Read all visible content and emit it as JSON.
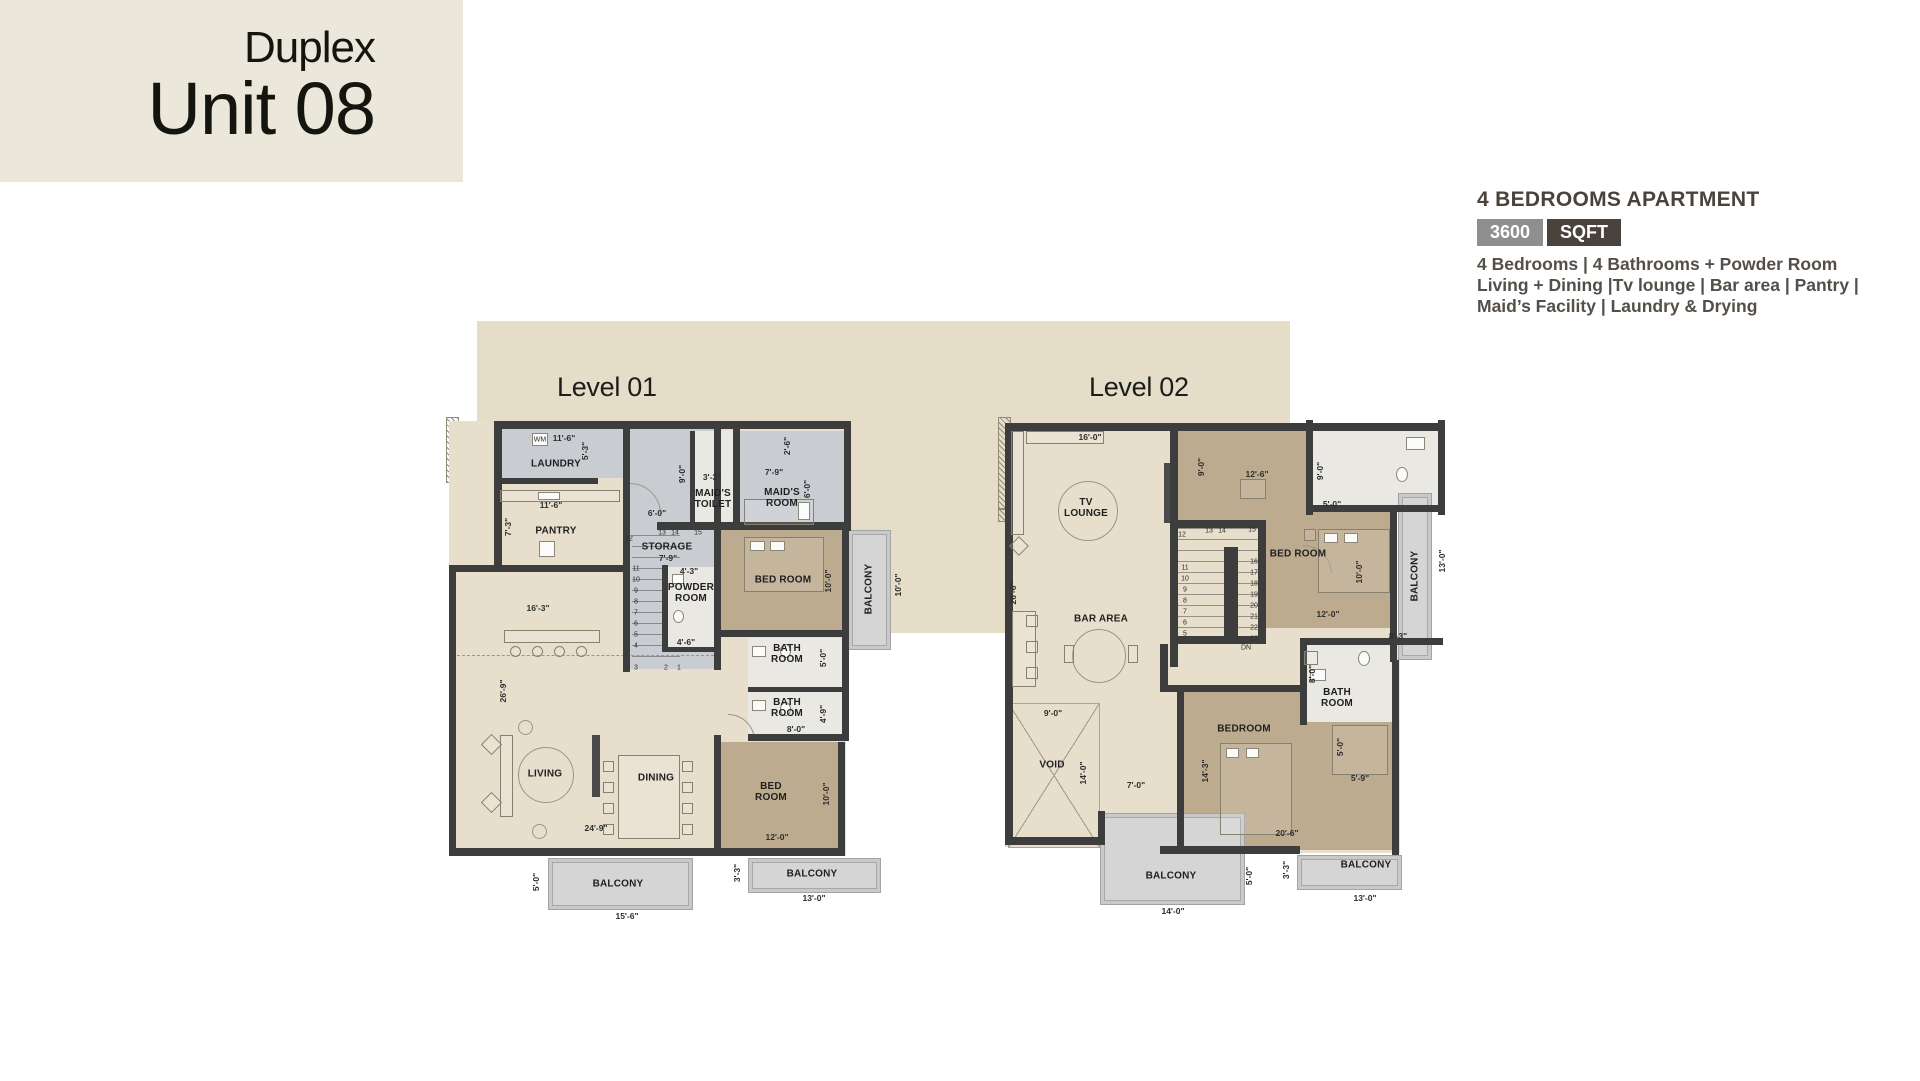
{
  "unit_card": {
    "subtitle": "Duplex",
    "title": "Unit 08"
  },
  "info": {
    "title": "4 BEDROOMS APARTMENT",
    "area_value": "3600",
    "area_unit": "SQFT",
    "features": [
      "4 Bedrooms  |  4 Bathrooms + Powder Room",
      "Living + Dining |Tv lounge  |  Bar area  |  Pantry  |",
      "Maid’s Facility  |  Laundry & Drying"
    ]
  },
  "colors": {
    "card_bg": "#ebe7da",
    "backdrop": "#e5ddc8",
    "wall": "#3d3d3d",
    "floor_cream": "#e7dfcc",
    "floor_grey": "#c9ccd1",
    "floor_bath": "#eae8e3",
    "floor_bedroom": "#bcab8f",
    "balcony": "#d5d5d6",
    "badge_grey": "#8f8f8f",
    "badge_dark": "#4a433b"
  },
  "levels": [
    {
      "label": "Level 01",
      "rooms": {
        "laundry": "LAUNDRY",
        "pantry": "PANTRY",
        "maids_toilet": "MAID'S\nTOILET",
        "maids_room": "MAID'S\nROOM",
        "storage": "STORAGE",
        "powder": "POWDER\nROOM",
        "bedroom1": "BED ROOM",
        "bath1": "BATH\nROOM",
        "bath2": "BATH\nROOM",
        "bedroom2": "BED\nROOM",
        "living": "LIVING",
        "dining": "DINING",
        "balcony_r": "BALCONY",
        "balcony_b": "BALCONY",
        "balcony_br": "BALCONY"
      },
      "dims": [
        {
          "t": "11'-6\"",
          "x": 118,
          "y": 21
        },
        {
          "t": "WM",
          "x": 94,
          "y": 23,
          "s": 1
        },
        {
          "t": "5'-3\"",
          "x": 139,
          "y": 34,
          "v": 1
        },
        {
          "t": "11'-6\"",
          "x": 105,
          "y": 88
        },
        {
          "t": "7'-3\"",
          "x": 62,
          "y": 110,
          "v": 1
        },
        {
          "t": "9'-0\"",
          "x": 236,
          "y": 57,
          "v": 1
        },
        {
          "t": "6'-0\"",
          "x": 211,
          "y": 96
        },
        {
          "t": "3'-3\"",
          "x": 266,
          "y": 60
        },
        {
          "t": "7'-9\"",
          "x": 328,
          "y": 55
        },
        {
          "t": "2'-6\"",
          "x": 341,
          "y": 29,
          "v": 1
        },
        {
          "t": "6'-0\"",
          "x": 361,
          "y": 72,
          "v": 1
        },
        {
          "t": "16'-3\"",
          "x": 92,
          "y": 191
        },
        {
          "t": "26'-9\"",
          "x": 57,
          "y": 274,
          "v": 1
        },
        {
          "t": "24'-9\"",
          "x": 150,
          "y": 411
        },
        {
          "t": "7'-9\"",
          "x": 222,
          "y": 141
        },
        {
          "t": "4'-3\"",
          "x": 243,
          "y": 154
        },
        {
          "t": "4'-6\"",
          "x": 240,
          "y": 225
        },
        {
          "t": "10'-0\"",
          "x": 382,
          "y": 164,
          "v": 1
        },
        {
          "t": "10'-0\"",
          "x": 452,
          "y": 168,
          "v": 1
        },
        {
          "t": "5'-0\"",
          "x": 377,
          "y": 241,
          "v": 1
        },
        {
          "t": "4'-9\"",
          "x": 377,
          "y": 297,
          "v": 1
        },
        {
          "t": "8'-0\"",
          "x": 350,
          "y": 312
        },
        {
          "t": "12'-0\"",
          "x": 331,
          "y": 420
        },
        {
          "t": "10'-0\"",
          "x": 380,
          "y": 377,
          "v": 1
        },
        {
          "t": "5'-0\"",
          "x": 90,
          "y": 465,
          "v": 1
        },
        {
          "t": "15'-6\"",
          "x": 181,
          "y": 499
        },
        {
          "t": "3'-3\"",
          "x": 291,
          "y": 456,
          "v": 1
        },
        {
          "t": "13'-0\"",
          "x": 368,
          "y": 481
        },
        {
          "t": "13",
          "x": 216,
          "y": 116,
          "s": 1
        },
        {
          "t": "14",
          "x": 229,
          "y": 116,
          "s": 1
        },
        {
          "t": "15",
          "x": 252,
          "y": 116,
          "s": 1
        },
        {
          "t": "12",
          "x": 183,
          "y": 122,
          "s": 1
        },
        {
          "t": "11",
          "x": 190,
          "y": 152,
          "s": 1
        },
        {
          "t": "10",
          "x": 190,
          "y": 163,
          "s": 1
        },
        {
          "t": "9",
          "x": 190,
          "y": 174,
          "s": 1
        },
        {
          "t": "8",
          "x": 190,
          "y": 185,
          "s": 1
        },
        {
          "t": "7",
          "x": 190,
          "y": 196,
          "s": 1
        },
        {
          "t": "6",
          "x": 190,
          "y": 207,
          "s": 1
        },
        {
          "t": "5",
          "x": 190,
          "y": 218,
          "s": 1
        },
        {
          "t": "4",
          "x": 190,
          "y": 229,
          "s": 1
        },
        {
          "t": "3",
          "x": 190,
          "y": 251,
          "s": 1
        },
        {
          "t": "2",
          "x": 220,
          "y": 251,
          "s": 1
        },
        {
          "t": "1",
          "x": 233,
          "y": 251,
          "s": 1
        }
      ]
    },
    {
      "label": "Level 02",
      "rooms": {
        "tv_lounge": "TV\nLOUNGE",
        "bar": "BAR AREA",
        "void": "VOID",
        "bedroom_t": "BED ROOM",
        "bedroom_b": "BEDROOM",
        "bath_b": "BATH\nROOM",
        "balcony_r": "BALCONY",
        "balcony_bl": "BALCONY",
        "balcony_br": "BALCONY"
      },
      "dims": [
        {
          "t": "16'-0\"",
          "x": 92,
          "y": 20
        },
        {
          "t": "26'-6\"",
          "x": 15,
          "y": 176,
          "v": 1
        },
        {
          "t": "9'-0\"",
          "x": 203,
          "y": 50,
          "v": 1
        },
        {
          "t": "12'-6\"",
          "x": 259,
          "y": 57
        },
        {
          "t": "9'-0\"",
          "x": 322,
          "y": 54,
          "v": 1
        },
        {
          "t": "5'-0\"",
          "x": 334,
          "y": 87
        },
        {
          "t": "10'-0\"",
          "x": 361,
          "y": 155,
          "v": 1
        },
        {
          "t": "12'-0\"",
          "x": 330,
          "y": 197
        },
        {
          "t": "13'-0\"",
          "x": 444,
          "y": 144,
          "v": 1
        },
        {
          "t": "8'-3\"",
          "x": 400,
          "y": 219
        },
        {
          "t": "8'-0\"",
          "x": 314,
          "y": 257,
          "v": 1
        },
        {
          "t": "5'-0\"",
          "x": 342,
          "y": 330,
          "v": 1
        },
        {
          "t": "5'-9\"",
          "x": 362,
          "y": 361
        },
        {
          "t": "14'-3\"",
          "x": 207,
          "y": 354,
          "v": 1
        },
        {
          "t": "20'-6\"",
          "x": 289,
          "y": 416
        },
        {
          "t": "9'-0\"",
          "x": 55,
          "y": 296
        },
        {
          "t": "14'-0\"",
          "x": 85,
          "y": 356,
          "v": 1
        },
        {
          "t": "7'-0\"",
          "x": 138,
          "y": 368
        },
        {
          "t": "14'-0\"",
          "x": 175,
          "y": 494
        },
        {
          "t": "5'-0\"",
          "x": 251,
          "y": 459,
          "v": 1
        },
        {
          "t": "3'-3\"",
          "x": 288,
          "y": 453,
          "v": 1
        },
        {
          "t": "13'-0\"",
          "x": 367,
          "y": 481
        },
        {
          "t": "DN",
          "x": 248,
          "y": 231,
          "s": 1
        },
        {
          "t": "12",
          "x": 184,
          "y": 118,
          "s": 1
        },
        {
          "t": "13",
          "x": 211,
          "y": 114,
          "s": 1
        },
        {
          "t": "14",
          "x": 224,
          "y": 114,
          "s": 1
        },
        {
          "t": "15",
          "x": 254,
          "y": 113,
          "s": 1
        },
        {
          "t": "11",
          "x": 187,
          "y": 151,
          "s": 1
        },
        {
          "t": "10",
          "x": 187,
          "y": 162,
          "s": 1
        },
        {
          "t": "9",
          "x": 187,
          "y": 173,
          "s": 1
        },
        {
          "t": "8",
          "x": 187,
          "y": 184,
          "s": 1
        },
        {
          "t": "7",
          "x": 187,
          "y": 195,
          "s": 1
        },
        {
          "t": "6",
          "x": 187,
          "y": 206,
          "s": 1
        },
        {
          "t": "5",
          "x": 187,
          "y": 217,
          "s": 1
        },
        {
          "t": "16",
          "x": 256,
          "y": 145,
          "s": 1
        },
        {
          "t": "17",
          "x": 256,
          "y": 156,
          "s": 1
        },
        {
          "t": "18",
          "x": 256,
          "y": 167,
          "s": 1
        },
        {
          "t": "19",
          "x": 256,
          "y": 178,
          "s": 1
        },
        {
          "t": "20",
          "x": 256,
          "y": 189,
          "s": 1
        },
        {
          "t": "21",
          "x": 256,
          "y": 200,
          "s": 1
        },
        {
          "t": "22",
          "x": 256,
          "y": 211,
          "s": 1
        },
        {
          "t": "23",
          "x": 256,
          "y": 222,
          "s": 1
        }
      ]
    }
  ]
}
